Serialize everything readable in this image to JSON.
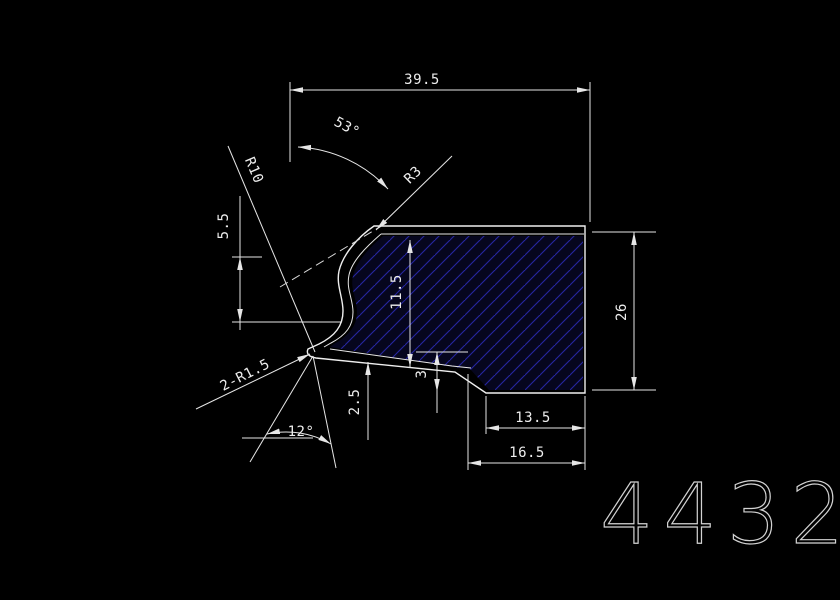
{
  "window": {
    "background": "#000000",
    "line_color": "#e6e6e6",
    "hatch_line_color": "#2626a0",
    "hatch_fill_color": "#06061e",
    "text_color": "#ededed",
    "part_number_color": "#d2d2d2"
  },
  "drawing": {
    "type": "cad-cross-section-profile",
    "dimensions": {
      "total_width": "39.5",
      "top_angle": "53°",
      "corner_radius": "R3",
      "groove_radius": "R10",
      "left_offset": "5.5",
      "inner_height": "11.5",
      "right_height": "26",
      "double_radius_note": "2-R1.5",
      "lip_thickness": "2.5",
      "step_height": "3",
      "bottom_angle": "12°",
      "step_width": "13.5",
      "bottom_width": "16.5"
    },
    "part_number": "4432"
  }
}
